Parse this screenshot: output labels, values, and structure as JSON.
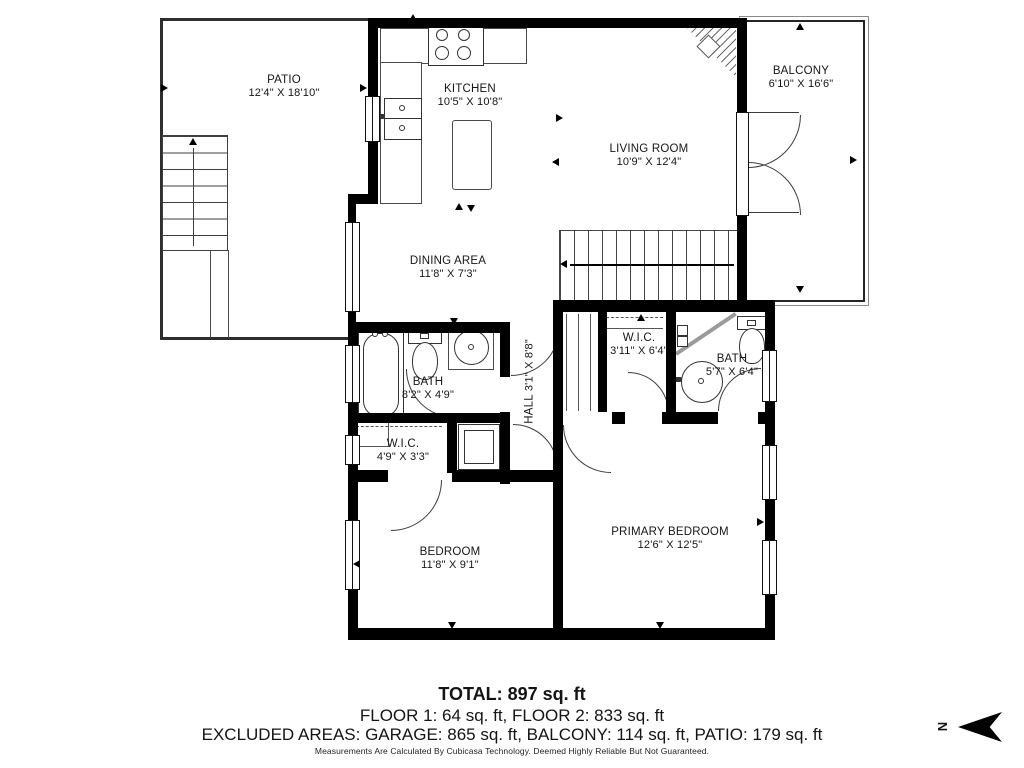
{
  "rooms": {
    "patio": {
      "name": "PATIO",
      "dims": "12'4\" X 18'10\""
    },
    "kitchen": {
      "name": "KITCHEN",
      "dims": "10'5\" X 10'8\""
    },
    "living": {
      "name": "LIVING ROOM",
      "dims": "10'9\" X 12'4\""
    },
    "balcony": {
      "name": "BALCONY",
      "dims": "6'10\" X 16'6\""
    },
    "dining": {
      "name": "DINING AREA",
      "dims": "11'8\" X 7'3\""
    },
    "bath1": {
      "name": "BATH",
      "dims": "8'2\" X 4'9\""
    },
    "hall": {
      "name": "HALL",
      "dims": "3'1\" X 8'8\""
    },
    "wic1": {
      "name": "W.I.C.",
      "dims": "4'9\" X 3'3\""
    },
    "wic2": {
      "name": "W.I.C.",
      "dims": "3'11\" X 6'4\""
    },
    "bath2": {
      "name": "BATH",
      "dims": "5'7\" X 6'4\""
    },
    "bedroom": {
      "name": "BEDROOM",
      "dims": "11'8\" X 9'1\""
    },
    "primary": {
      "name": "PRIMARY BEDROOM",
      "dims": "12'6\" X 12'5\""
    }
  },
  "summary": {
    "total": "TOTAL: 897 sq. ft",
    "floors": "FLOOR 1: 64 sq. ft, FLOOR 2: 833 sq. ft",
    "excluded": "EXCLUDED AREAS: GARAGE: 865 sq. ft, BALCONY: 114 sq. ft, PATIO: 179 sq. ft",
    "disclaimer": "Measurements Are Calculated By Cubicasa Technology. Deemed Highly Reliable But Not Guaranteed."
  },
  "compass": {
    "north_label": "N"
  },
  "colors": {
    "wall": "#000000",
    "line": "#3d3d3d"
  }
}
